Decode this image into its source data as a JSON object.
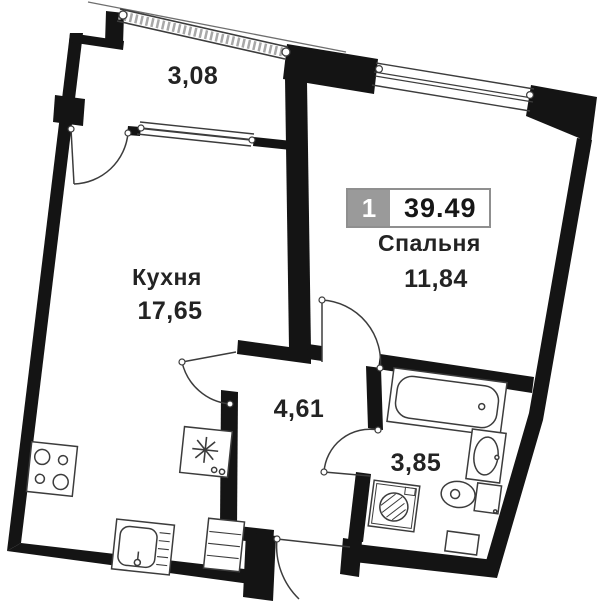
{
  "badge": {
    "number": "1",
    "total_area": "39.49"
  },
  "rooms": {
    "balcony": {
      "area": "3,08"
    },
    "kitchen": {
      "name": "Кухня",
      "area": "17,65"
    },
    "bedroom": {
      "name": "Спальня",
      "area": "11,84"
    },
    "hallway": {
      "area": "4,61"
    },
    "bathroom": {
      "area": "3,85"
    }
  },
  "colors": {
    "wall": "#141414",
    "line": "#3c3c3c",
    "badge_gray": "#9a9a9a",
    "badge_border": "#8f8f8f",
    "text": "#232323"
  }
}
